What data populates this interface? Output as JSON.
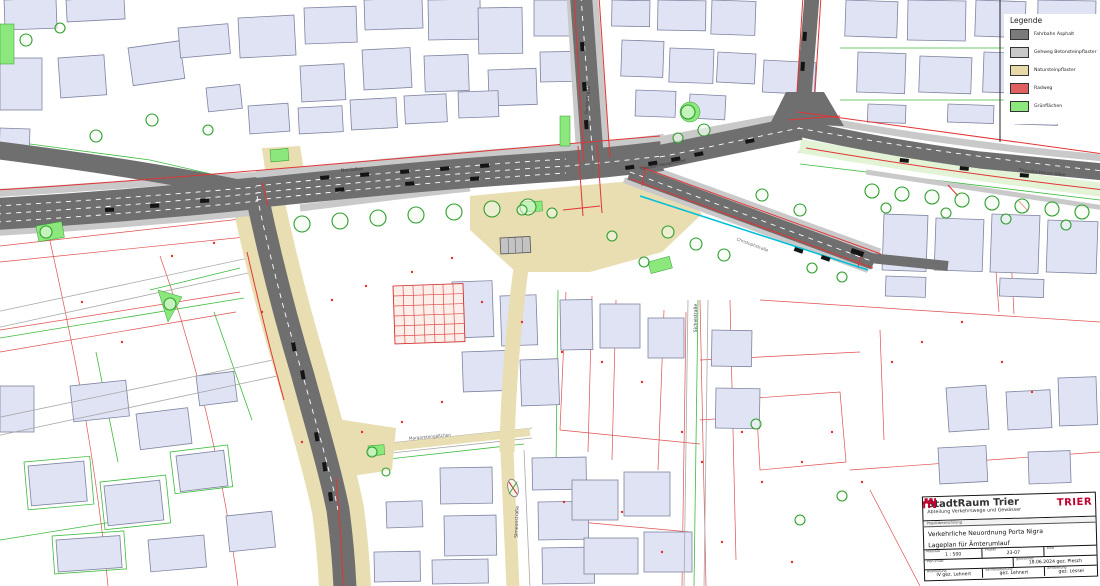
{
  "legend": {
    "title": "Legende",
    "items": [
      {
        "name": "fahrbahn-asphalt",
        "label": "Fahrbahn Asphalt",
        "color": "#7a7a7a"
      },
      {
        "name": "gehweg-betonsteinpflaster",
        "label": "Gehweg Betonsteinpflaster",
        "color": "#c8c8c8"
      },
      {
        "name": "natursteinpflaster",
        "label": "Natursteinpflaster",
        "color": "#e8daa8"
      },
      {
        "name": "radweg",
        "label": "Radweg",
        "color": "#e06060"
      },
      {
        "name": "gruenflaechen",
        "label": "Grünflächen",
        "color": "#8ce87c"
      }
    ]
  },
  "street_labels": {
    "paulinstrasse": "Paulinstraße",
    "nordallee": "Nordallee",
    "theodor_heuss_allee_mid": "Theodor-Heuss-Allee",
    "theodor_heuss_allee_east": "Theodor-Heuss-Allee",
    "christophstrasse": "Christophstraße",
    "sichelstrasse": "Sichelstraße",
    "simeonstrasse": "Simeonstraße",
    "margaretengaesschen": "Margaretengäßchen"
  },
  "title_block": {
    "org": "StadtRaum Trier",
    "department": "Abteilung Verkehrswege und Gewässer",
    "logo_text": "TRIER",
    "header_label": "Projektbezeichnung",
    "project_line1": "Verkehrliche Neuordnung Porta Nigra",
    "project_line2": "Lageplan für Ämterumlauf",
    "fields": {
      "massstab_label": "Maßstab",
      "massstab_value": "1 : 500",
      "projekt_label": "Projekt",
      "projekt_value": "23-07",
      "blatt_label": "Blatt",
      "blatt_value": "",
      "plan_label": "Plan-Inhalt",
      "plan_value": "",
      "gezeichnet_label": "gezeichnet",
      "gezeichnet_value": "18.06.2024 gez. Plesch",
      "bearbeitung_label": "Bearbeitung",
      "bearbeitung_value": "IV gez. Lehnert",
      "sachbearb_label": "Sachbearbeitung",
      "sachbearb_value": "gez. Lehnert",
      "amtsleitung_label": "Amtsleitung",
      "amtsleitung_value": "gez. Lessel"
    }
  },
  "colors": {
    "asphalt": "#6f6f6f",
    "sidewalk": "#c9c9c9",
    "naturstein": "#e9ddb2",
    "radweg_red": "#e23535",
    "gruen": "#8ce87c",
    "building": "#dfe3f4",
    "cycle_cyan": "#00c0d8",
    "logo_red": "#c4002e"
  }
}
